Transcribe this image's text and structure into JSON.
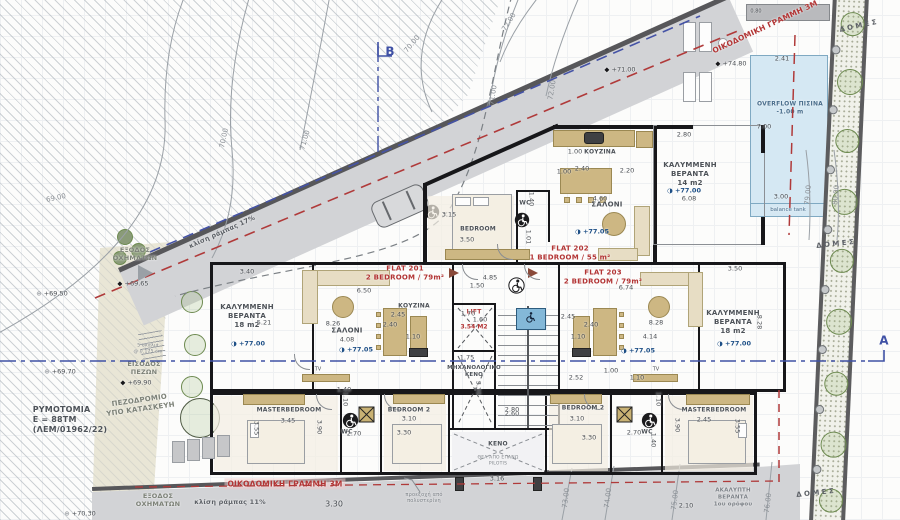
{
  "flats": {
    "f201name": "FLAT 201",
    "f201spec": "2 BEDROOM / 79m²",
    "f202name": "FLAT 202",
    "f202spec": "1 BEDROOM / 55 m²",
    "f203name": "FLAT 203",
    "f203spec": "2 BEDROOM / 79m²"
  },
  "rooms": {
    "veranda1": "ΚΑΛΥΜΜΕΝΗ",
    "veranda2": "ΒΕΡΑΝΤΑ",
    "v18": "18 m2",
    "v14": "14 m2",
    "saloni": "ΣΑΛΟΝΙ",
    "kouzina": "ΚΟΥΖΙΝΑ",
    "bedroom": "BEDROOM",
    "bedroom2": "BEDROOM 2",
    "master": "MASTERBEDROOM",
    "wc": "WC",
    "lift": "LIFT",
    "lift_area": "3.54 Μ2",
    "mech1": "ΜΗΧΑΝΟΛΟΓΙΚΟ",
    "mech2": "ΚΕΝΟ",
    "keno": "ΚΕΝΟ",
    "keno_sub1": "ΘΕΑ ΑΠΟ ΕΠΑΝΩ",
    "keno_sub2": "PILOTIS",
    "tv": "TV",
    "akal1": "ΑΚΑΛΥΠΤΗ",
    "akal2": "ΒΕΡΑΝΤΑ",
    "akal3": "1ου ορόφου"
  },
  "site": {
    "oikodomiki": "ΟΙΚΟΔΟΜΙΚΗ ΓΡΑΜΜΗ 3Μ",
    "rym1": "ΡΥΜΟΤΟΜΙΑ",
    "rym2": "Ε = 88ΤΜ",
    "rym3": "(ΛΕΜ/01962/22)",
    "pez1": "ΠΕΖΟΔΡΟΜΙΟ",
    "pez2": "ΥΠΟ ΚΑΤΑΣΚΕΥΗ",
    "exo1": "ΕΞΟΔΟΣ",
    "exo2": "ΟΧΗΜΑΤΩΝ",
    "eis1": "ΕΙΣΟΔΟΣ",
    "eis2": "ΠΕΖΩΝ",
    "klisi17a": "κλίση",
    "klisi17b": "ράμπας 17%",
    "klisi11a": "κλίση",
    "klisi11b": "ράμπας 11%",
    "skalia1": "5 σκαλιά",
    "skalia2": "@ 0.175 cm",
    "proex1": "προεξοχή από",
    "proex2": "πολυστερίνη",
    "domes": "Δ Ο Μ Ε Σ",
    "overflow": "OVERFLOW ΠΙΣΙΝΑ",
    "depth": "-1.00 m",
    "balance": "balance tank",
    "secA": "A",
    "secB": "B"
  },
  "markers": {
    "m6950": "+69.50",
    "m6965": "+69.65",
    "m6970": "+69.70",
    "m6990": "+69.90",
    "m7030": "+70.30",
    "m7100": "+71.00",
    "m7480": "+74.80",
    "m7700": "+77.00",
    "m7705": "+77.05"
  },
  "contours": {
    "c69": "69.00",
    "c70": "70.00",
    "c71": "71.00",
    "c72": "72.00",
    "c73": "73.00",
    "c74": "74.00",
    "c75": "75.00",
    "c76": "76.00",
    "c79": "79.00",
    "c80": "80.00"
  },
  "dims": {
    "d1": "3.40",
    "d2": "5.21",
    "d3": "8.26",
    "d4": "4.08",
    "d5": "6.50",
    "d6": "2.45",
    "d7": "2.40",
    "d8": "1.10",
    "d9": "1.70",
    "d10": "1.60",
    "d12": "1.75",
    "d13": "3.30",
    "d14": "2.60",
    "d15": "4.85",
    "d16": "1.50",
    "d17": "6.74",
    "d18": "8.28",
    "d19": "4.14",
    "d20": "2.45",
    "d21": "2.40",
    "d22": "1.10",
    "d23": "2.52",
    "d24": "1.00",
    "d25": "1.10",
    "d26": "3.50",
    "d27": "8.28",
    "d28": "2.80",
    "d29": "6.08",
    "d30": "1.00",
    "d31": "2.40",
    "d32": "2.20",
    "d33": "4.60",
    "d34": "1.40",
    "d35": "1.01",
    "d36": "3.15",
    "d37": "3.50",
    "d38": "3.45",
    "d39": "3.55",
    "d40": "3.90",
    "d41": "2.70",
    "d42": "1.40",
    "d43": "1.10",
    "d44": "3.10",
    "d45": "3.30",
    "d46": "3.10",
    "d47": "3.30",
    "d48": "2.70",
    "d49": "1.40",
    "d50": "1.10",
    "d51": "2.45",
    "d52": "3.90",
    "d53": "3.55",
    "d54": "2.80",
    "d55": "3.16",
    "d56": "3.30",
    "d57": "2.10",
    "d58": "2.41",
    "d59": "7.00",
    "d60": "3.00",
    "d61": "0.80",
    "d62": "1.00"
  }
}
